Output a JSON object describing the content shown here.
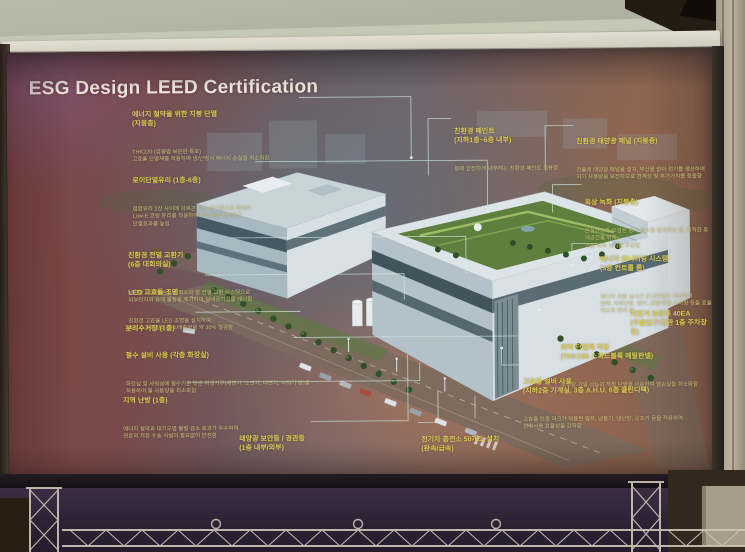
{
  "slide": {
    "title_lines": "ESG Design\nLEED\nCertification",
    "colors": {
      "slide_maroon": "#7d4342",
      "label_yellow": "#d6c94e",
      "leader_line": "#cfeae4",
      "title_white": "#ece4dc",
      "green_roof": "#5e7f3e"
    },
    "annotations": [
      {
        "id": "roof-insulation",
        "title": "에너지 절약을 위한 지붕 단열\n(지붕층)",
        "desc": "THK220 (압출법 보온판 특호)\n고효율 단열재를 적용하여 냉/난방시 에너지 손실을 최소화함"
      },
      {
        "id": "low-e-glass",
        "title": "로이단열유리 (1층-6층)",
        "desc": "접합유리 2장 사이에 아르곤 가스 공기층으로 채워져\nLow-E 코팅 유리를 적용하여 에너지를 차단하고\n단열효과를 높임"
      },
      {
        "id": "heat-exchanger",
        "title": "친환경 전열 교환기\n(6층 대회의실)",
        "desc": "냉난방 에너지 손실을 최소화 할 전열 교환 시스템으로\n외부먼지와 유해 물질을 제거하여 실내공기질을 개선함"
      },
      {
        "id": "led-lighting",
        "title": "LED 고효율 조명",
        "desc": "친환경 고효율 LED 조명을 설치하여\n에너지 소비량과 탄소배출량을 약 30% 절감함"
      },
      {
        "id": "recycling-station",
        "title": "분리수거장 (1층)",
        "desc": ""
      },
      {
        "id": "water-saving",
        "title": "절수 설비 사용 (각층 화장실)",
        "desc": "화장실 및 샤워실에 절수기준 맞춘 위생기구(세면기, 소변기, 대변기, 샤워기 등)를\n적용하여 물 사용량을 최소화함"
      },
      {
        "id": "district-heating",
        "title": "지역 난방 (1층)",
        "desc": "에너지 절약과 대기오염 물질 감소 효과가 우수하며\n연료의 저장 수송 시설이 필요없어 안전함"
      },
      {
        "id": "solar-security-lights",
        "title": "태양광 보안등 / 경관등\n(1층 내부/외부)",
        "desc": ""
      },
      {
        "id": "ev-charging",
        "title": "전기차 충전소 50개소 설치\n(완속/급속)",
        "desc": ""
      },
      {
        "id": "eco-paint",
        "title": "친환경 페인트\n(지하1층~6층 내부)",
        "desc": "몸에 안전하게 내부에는 친환경 페인트 적용함"
      },
      {
        "id": "solar-panels",
        "title": "친환경 태양광 패널 (지붕층)",
        "desc": "건물에 태양광 패널을 설치, 부산물 없이 전기를 생산하여\n자가 사용량을 보전하므로 경제성 및 부가가치를 창출함"
      },
      {
        "id": "green-roof",
        "title": "옥상 녹화 (지붕층)",
        "desc": "온실가스와 오염된 공기 흡수를 줄여주는 등, 쾌적한 휴게공간을 위해\n건물 위에 녹지를 조성함"
      },
      {
        "id": "energy-monitoring",
        "title": "에너지 모니터링 시스템\n(3층 컨트롤 룸)",
        "desc": "에너지 사용 실시간 모니터링이 가능하여\n전력, 지역난방, 설비, 조명/전열 소비량 등을 효율적으로 제어 함"
      },
      {
        "id": "bike-rack",
        "title": "자전거 보관대 40EA\n(주출입구/별관 1층 주차장 앞)",
        "desc": ""
      },
      {
        "id": "wall-insulation",
        "title": "외벽 단열재 적용\n(THK155 스피드블록 메탈판넬)",
        "desc": "우수한 기밀 성능과 적정 단열을 사용하여 열손실을 최소화함"
      },
      {
        "id": "hvac-equipment",
        "title": "고효율 설비 사용\n(지하2층 기계실, 3층 A.H.U, 6층 클린디팩)",
        "desc": "고효율 인증 마크가 적용된 펌프, 냉동기, 냉난방, 공조기 등을 적용하여\n전력사용 효율성을 강화함"
      }
    ]
  }
}
